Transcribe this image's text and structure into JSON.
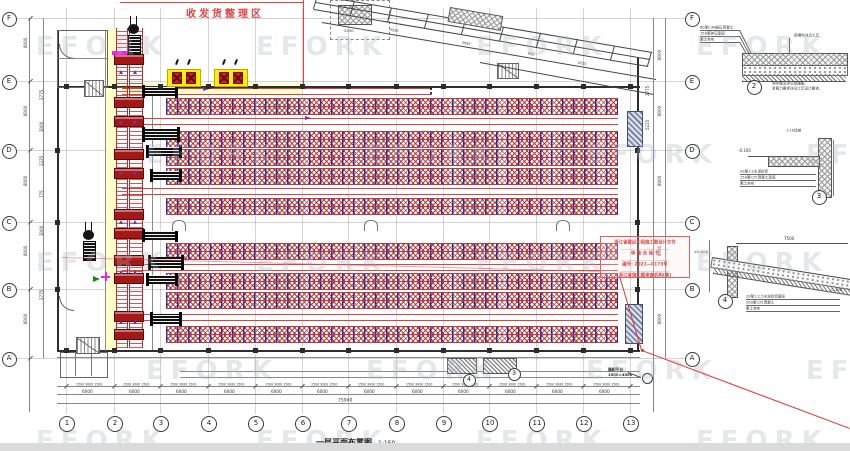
{
  "title_block": {
    "title": "一层平面布置图",
    "scale": "1:150"
  },
  "zone_label": {
    "text": "收发货整理区",
    "color": "#e04545"
  },
  "stamp": {
    "lines": [
      "浙江省建设工程施工图设计文件",
      "审 查 合 格 书",
      "编号: 2021—0173号",
      "浙江省施工图审查机构(章)"
    ],
    "border_color": "#e06060"
  },
  "watermark": {
    "text": "EFORK",
    "color": "#a8b2c0",
    "opacity": 0.3,
    "rows": [
      32,
      140,
      248,
      356,
      426
    ],
    "xs_even": [
      36,
      256,
      476,
      696
    ],
    "xs_odd": [
      146,
      366,
      586,
      806
    ]
  },
  "grid": {
    "cols": [
      [
        "1",
        66
      ],
      [
        "2",
        114
      ],
      [
        "3",
        160
      ],
      [
        "4",
        208
      ],
      [
        "5",
        255
      ],
      [
        "6",
        302
      ],
      [
        "7",
        348
      ],
      [
        "8",
        396
      ],
      [
        "9",
        443
      ],
      [
        "10",
        489
      ],
      [
        "11",
        536
      ],
      [
        "12",
        583
      ],
      [
        "13",
        630
      ]
    ],
    "rows": [
      [
        "F",
        18
      ],
      [
        "E",
        81
      ],
      [
        "D",
        150
      ],
      [
        "C",
        222
      ],
      [
        "B",
        289
      ],
      [
        "A",
        358
      ]
    ]
  },
  "texts": {
    "left_dims": [
      [
        "8000",
        24,
        48
      ],
      [
        "8000",
        24,
        116
      ],
      [
        "8000",
        24,
        186
      ],
      [
        "8000",
        24,
        256
      ],
      [
        "8000",
        24,
        324
      ],
      [
        "2775",
        40,
        100
      ],
      [
        "3000",
        40,
        132
      ],
      [
        "2225",
        40,
        166
      ],
      [
        "775",
        40,
        198
      ],
      [
        "3000",
        40,
        236
      ],
      [
        "2775",
        40,
        300
      ]
    ],
    "right_dims": [
      [
        "8000",
        658,
        60
      ],
      [
        "8000",
        658,
        116
      ],
      [
        "8000",
        658,
        186
      ],
      [
        "8000",
        658,
        256
      ],
      [
        "8000",
        658,
        324
      ],
      [
        "2775",
        646,
        96
      ],
      [
        "5225",
        646,
        130
      ]
    ],
    "bottom_bay": "6000",
    "bottom_sub": "1500 3000 1500",
    "bottom_total": "75940",
    "ramp_dims": [
      [
        "4250",
        390,
        28
      ],
      [
        "3050",
        462,
        41
      ],
      [
        "950",
        528,
        52
      ],
      [
        "4250",
        578,
        61
      ]
    ],
    "box2450": "2450",
    "platform_note": [
      "装卸平台",
      "1500×4500"
    ],
    "detail2": {
      "no": "2",
      "left": [
        "60厚C30细石混凝土",
        "150厚碎石垫层",
        "素土夯实"
      ],
      "right": "预埋件详见工艺",
      "note1": "地坪做法详见结施图,",
      "note2": "承载力要求详见工艺设计要求。"
    },
    "detail3": {
      "no": "3",
      "left": [
        "20厚1:2水泥砂浆",
        "150厚C25混凝土垫层",
        "素土夯实"
      ],
      "top": "1:10找坡",
      "elev": "-0.100"
    },
    "detail4": {
      "no": "4",
      "left": [
        "20厚1:2.5水泥砂浆面层",
        "200厚C25混凝土",
        "素土夯实"
      ],
      "dim": "7500",
      "elev_l": "±0.000",
      "elev_r": "-0.150"
    }
  },
  "colors": {
    "rack_blue": "#272f96",
    "rack_red": "#ba2222",
    "conveyor_red": "#a51818",
    "highlight_yellow": "#ffef00",
    "corridor_yellow": "#ffffcc",
    "leader_red": "#e03535",
    "accent_magenta": "#ee22ee",
    "accent_green": "#0b8f0b",
    "accent_purple": "#7b2fa0"
  },
  "geometry": {
    "canvas": {
      "w": 850,
      "h": 451
    },
    "walls": [
      [
        57,
        86,
        583,
        2
      ],
      [
        57,
        350,
        583,
        2
      ],
      [
        57,
        30,
        2,
        322
      ],
      [
        637,
        58,
        2,
        294
      ]
    ],
    "thin_lines": [
      [
        105,
        30,
        1,
        321
      ],
      [
        152,
        88,
        1,
        262
      ],
      [
        57,
        30,
        50,
        1
      ],
      [
        57,
        58,
        50,
        1
      ],
      [
        57,
        357,
        583,
        1
      ],
      [
        180,
        371,
        460,
        1
      ],
      [
        180,
        377,
        460,
        1
      ]
    ],
    "rack_upper": {
      "x": 166,
      "w": 452,
      "h": 7,
      "ys": [
        98,
        106,
        131,
        139,
        149,
        157,
        168,
        176,
        198,
        206
      ]
    },
    "rack_lower": {
      "x": 166,
      "w": 452,
      "h": 7,
      "ys": [
        243,
        251,
        273,
        281,
        292,
        300,
        326,
        334
      ]
    },
    "red_pairs": [
      [
        122,
        88,
        310
      ],
      [
        122,
        118,
        496
      ],
      [
        122,
        188,
        496
      ],
      [
        122,
        264,
        496
      ],
      [
        122,
        314,
        496
      ]
    ],
    "conveyors": [
      [
        116,
        28,
        10,
        320
      ],
      [
        129,
        28,
        12,
        320
      ]
    ],
    "stations": {
      "x": 114,
      "w": 28,
      "h": 9,
      "ys": [
        54,
        97,
        116,
        149,
        168,
        209,
        228,
        255,
        273,
        311,
        329
      ]
    },
    "machines": [
      [
        144,
        87,
        32,
        9
      ],
      [
        144,
        129,
        34,
        11
      ],
      [
        148,
        147,
        32,
        9
      ],
      [
        152,
        171,
        28,
        9
      ],
      [
        144,
        231,
        32,
        9
      ],
      [
        150,
        257,
        32,
        11
      ],
      [
        148,
        275,
        28,
        9
      ],
      [
        152,
        314,
        28,
        10
      ]
    ],
    "yellow_boxes": [
      [
        167,
        69,
        32,
        16
      ],
      [
        214,
        69,
        32,
        16
      ]
    ],
    "hooks": [
      [
        176,
        59
      ],
      [
        188,
        59
      ],
      [
        223,
        59
      ],
      [
        235,
        59
      ]
    ],
    "docks": [
      [
        627,
        111,
        14,
        34
      ],
      [
        625,
        304,
        16,
        38
      ]
    ],
    "stairs": [
      [
        84,
        80,
        18,
        15
      ],
      [
        497,
        63,
        20,
        14
      ],
      [
        76,
        337,
        22,
        15
      ]
    ],
    "bottom_ramps": [
      [
        447,
        358,
        28,
        14
      ],
      [
        483,
        358,
        32,
        14
      ]
    ],
    "u_columns": [
      [
        172,
        220
      ],
      [
        364,
        220
      ],
      [
        556,
        220
      ]
    ],
    "dashed_box": [
      330,
      0,
      58,
      38
    ],
    "red_vline": [
      303,
      0,
      1,
      87
    ],
    "red_hline": [
      120,
      2,
      183,
      1
    ],
    "ramp_lines": [
      [
        318,
        -5,
        652,
        52
      ],
      [
        316,
        2,
        650,
        59
      ],
      [
        314,
        9,
        648,
        66
      ],
      [
        322,
        22,
        656,
        79
      ],
      [
        480,
        62,
        654,
        94
      ]
    ],
    "ramp_hatch": [
      450,
      7,
      52,
      13
    ],
    "redlines": [
      [
        620,
        276,
        642,
        350
      ],
      [
        642,
        350,
        850,
        428
      ],
      [
        62,
        257,
        600,
        271
      ]
    ],
    "dim_lines": [
      [
        30,
        18,
        30,
        412
      ],
      [
        44,
        18,
        44,
        358
      ],
      [
        654,
        18,
        654,
        412
      ],
      [
        666,
        18,
        666,
        358
      ],
      [
        57,
        386,
        640,
        386
      ],
      [
        57,
        394,
        640,
        394
      ],
      [
        57,
        403,
        640,
        403
      ]
    ],
    "forklifts": [
      [
        127,
        24
      ],
      [
        82,
        230
      ]
    ],
    "arrows": [
      [
        203,
        87
      ],
      [
        305,
        116
      ]
    ],
    "conv_arrow_ys": [
      70,
      120,
      170,
      220,
      270,
      320
    ],
    "magenta_bar": [
      112,
      51,
      15,
      4
    ],
    "green_arrow": [
      93,
      276
    ],
    "magenta_cross": [
      101,
      272
    ],
    "rooms": {
      "tl": [
        57,
        30,
        49,
        56
      ],
      "bl": [
        60,
        352,
        46,
        24
      ],
      "bl_lines": [
        75,
        91
      ]
    },
    "door_arcs": [
      [
        59,
        44,
        14
      ],
      [
        59,
        296,
        14
      ]
    ],
    "black_dots": [
      [
        430,
        88
      ],
      [
        430,
        92
      ]
    ],
    "callout_circles": [
      [
        468,
        379,
        11,
        "4"
      ],
      [
        513,
        373,
        11,
        "3"
      ],
      [
        646,
        377,
        9,
        ""
      ]
    ],
    "detail2": {
      "slab": [
        742,
        53,
        104,
        12
      ],
      "gravel": [
        742,
        65,
        104,
        9
      ],
      "soil": [
        742,
        74,
        104,
        7
      ],
      "circle": [
        753,
        86
      ],
      "bolt": [
        790,
        38,
        790,
        53
      ]
    },
    "detail3": {
      "wall": [
        818,
        138,
        12,
        58
      ],
      "slab": [
        768,
        156,
        50,
        9
      ],
      "slab_line": [
        748,
        156,
        768,
        156
      ],
      "circle": [
        818,
        196
      ],
      "vline": [
        834,
        140,
        834,
        196
      ]
    },
    "detail4": {
      "dim": [
        736,
        243,
        848,
        243
      ],
      "col": [
        727,
        246,
        9,
        50
      ],
      "slope": [
        712,
        257,
        140,
        9
      ],
      "soil": [
        714,
        267,
        140,
        6
      ],
      "circle": [
        724,
        300
      ],
      "vline": [
        710,
        240,
        710,
        292
      ]
    }
  }
}
